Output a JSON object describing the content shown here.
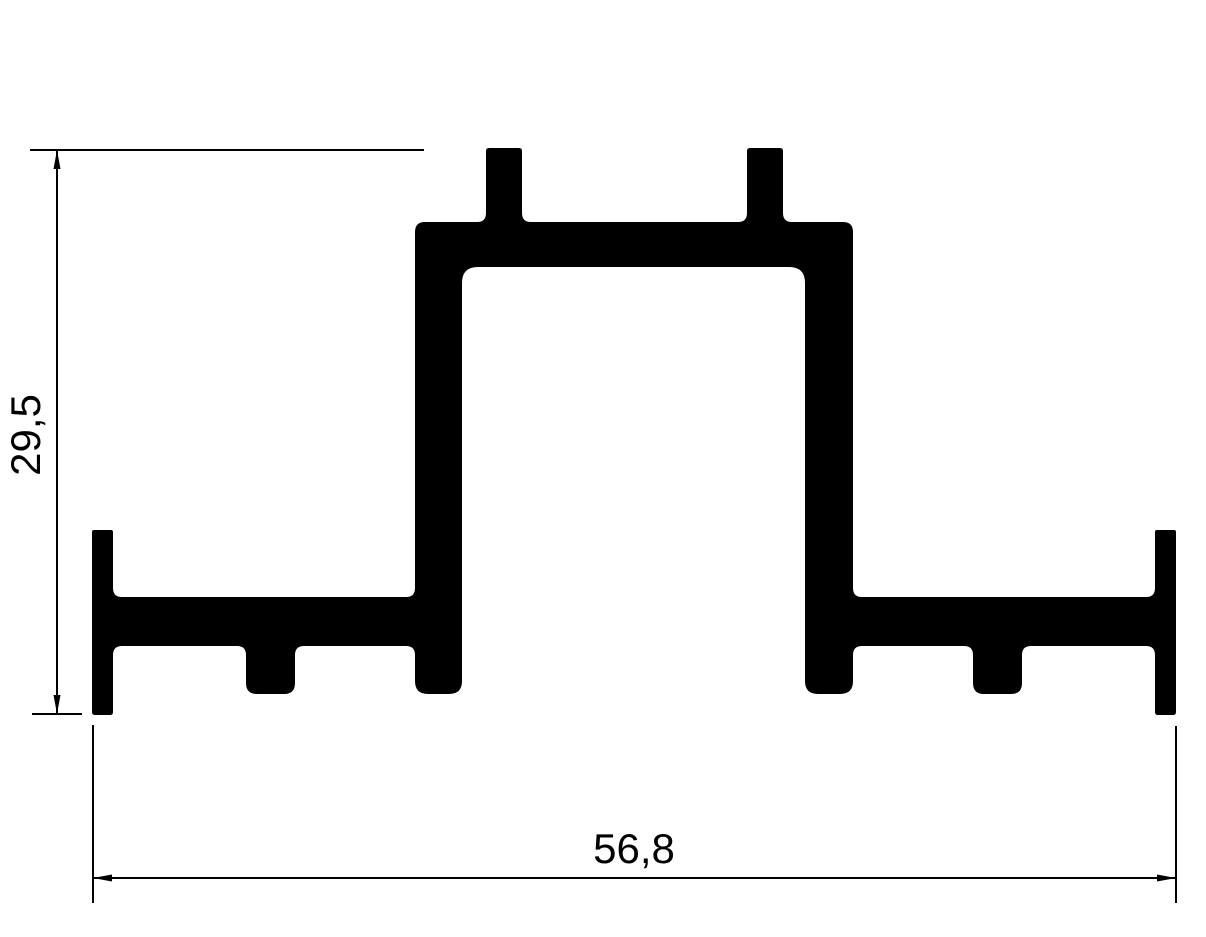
{
  "drawing": {
    "ink": "#000000",
    "background": "#ffffff",
    "dimensions": {
      "height_label": "29,5",
      "width_label": "56,8"
    }
  }
}
